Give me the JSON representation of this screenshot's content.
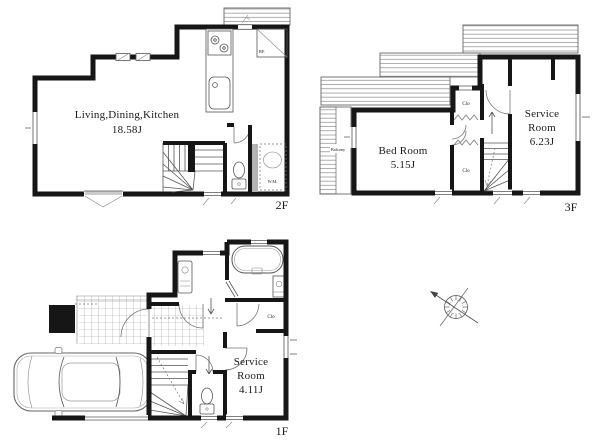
{
  "floors": [
    {
      "label": "2F",
      "rooms": [
        {
          "name": "Living,Dining,Kitchen",
          "area": "18.58J"
        }
      ],
      "labels": {
        "refrigerator": "RF.",
        "washer": "W.M."
      }
    },
    {
      "label": "3F",
      "rooms": [
        {
          "name": "Bed Room",
          "area": "5.15J"
        },
        {
          "name": "Service Room",
          "name_lines": [
            "Service",
            "Room"
          ],
          "area": "6.23J"
        }
      ],
      "labels": {
        "closet_upper": "Clo",
        "closet_lower": "Clo",
        "balcony": "Balcony"
      }
    },
    {
      "label": "1F",
      "rooms": [
        {
          "name": "Service Room",
          "name_lines": [
            "Service",
            "Room"
          ],
          "area": "4.11J"
        }
      ],
      "labels": {
        "closet": "Clo"
      }
    }
  ]
}
